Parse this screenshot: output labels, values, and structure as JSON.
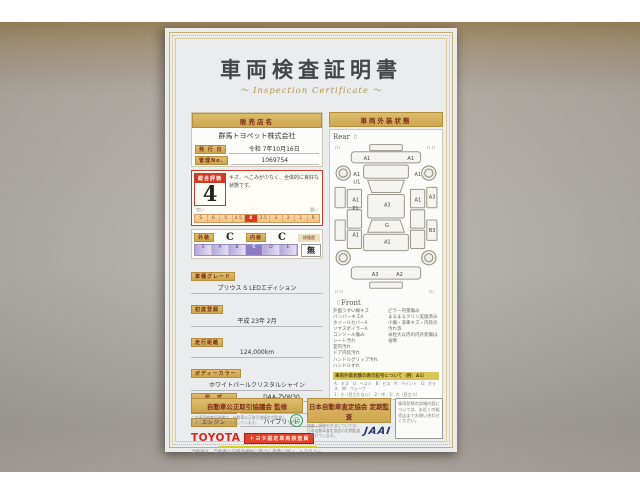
{
  "document": {
    "title": "車両検査証明書",
    "subtitle": "～ Inspection Certificate ～"
  },
  "colors": {
    "gold_bar": "#cda64f",
    "rating_red": "#cf3a26",
    "highlight_yellow": "#f2ee2a",
    "toyota_red": "#d8261c",
    "jaai_navy": "#23366e",
    "seal_green": "#2e9e4f",
    "paper": "#ebeced"
  },
  "left": {
    "dealer_header": "販売店名",
    "dealer_name": "群馬トヨペット株式会社",
    "issue_label": "発 行 日",
    "issue_value": "令和 7年10月16日",
    "manage_label": "管理No.",
    "manage_value": "1069754",
    "rating": {
      "label": "総合評価",
      "value": "4",
      "comment": "キズ、へこみが少なく、全体的に良好な状態です。",
      "scale": [
        "S",
        "6",
        "5",
        "4.5",
        "4",
        "3.5",
        "3",
        "2",
        "1",
        "R"
      ],
      "selected": "4",
      "good_label": "良い",
      "bad_label": "悪い"
    },
    "grade_row": {
      "ext_label": "外装",
      "ext_value": "C",
      "int_label": "内装",
      "int_value": "C",
      "repair_label": "修復歴",
      "repair_value": "無",
      "letters": [
        "S",
        "A",
        "B",
        "C",
        "D",
        "E"
      ],
      "selected_letter": "C"
    },
    "fields": [
      {
        "label": "車種グレード",
        "value": "プリウス S LEDエディション",
        "stacked": true
      },
      {
        "label": "初度登録",
        "value": "平成 23年 2月",
        "stacked": true
      },
      {
        "label": "走行距離",
        "value": "124,000km",
        "stacked": true
      },
      {
        "label": "ボディーカラー",
        "value": "ホワイトパールクリスタルシャイン",
        "stacked": true
      },
      {
        "label": "型　式",
        "value": "DAA-ZVW30",
        "stacked": false
      },
      {
        "label": "車台番号",
        "value": "XXXXXXX021",
        "stacked": false
      },
      {
        "label": "エンジン",
        "value": "ハイブリッド",
        "stacked": false
      }
    ],
    "toyota_logo": "TOYOTA",
    "inspector_badge": "トヨタ認定車両検査員",
    "disclaimer": "当検査は、自動車公正競争規約に基づく基準に従い、トヨタユーゼックが認定した検査員が厳正に検査・評価いたしました。"
  },
  "right": {
    "header": "車両外装状態",
    "rear_label": "Rear",
    "front_label": "Front",
    "diagram_labels": [
      {
        "t": "A1",
        "x": 30,
        "y": 17
      },
      {
        "t": "A1",
        "x": 73,
        "y": 17
      },
      {
        "t": "A1",
        "x": 20,
        "y": 33
      },
      {
        "t": "U1",
        "x": 20,
        "y": 40
      },
      {
        "t": "A1",
        "x": 19,
        "y": 58
      },
      {
        "t": "P1",
        "x": 19,
        "y": 66
      },
      {
        "t": "A1",
        "x": 19,
        "y": 92
      },
      {
        "t": "A3",
        "x": 50,
        "y": 63
      },
      {
        "t": "G",
        "x": 51,
        "y": 83
      },
      {
        "t": "A1",
        "x": 50,
        "y": 99
      },
      {
        "t": "A1",
        "x": 80,
        "y": 33
      },
      {
        "t": "A1",
        "x": 80,
        "y": 58
      },
      {
        "t": "A3",
        "x": 94,
        "y": 55
      },
      {
        "t": "B3",
        "x": 94,
        "y": 88
      },
      {
        "t": "A3",
        "x": 38,
        "y": 131
      },
      {
        "t": "A2",
        "x": 62,
        "y": 131
      }
    ],
    "wheel_marks": [
      {
        "t": "(1)",
        "x": 2,
        "y": 6
      },
      {
        "t": "(1.1)",
        "x": 92,
        "y": 6
      },
      {
        "t": "(2.1)",
        "x": 2,
        "y": 147
      },
      {
        "t": "(1)",
        "x": 94,
        "y": 147
      }
    ],
    "notes_left": [
      "外面うすい線キズ",
      "バンパーキズA",
      "ホイールカバーA",
      "リヤスポイラーA",
      "コンソール傷み",
      "シート汚れ",
      "室内汚れ",
      "ドア内装汚れ",
      "ハンドルグリップ汚れ",
      "ハンドルすれ"
    ],
    "notes_right": [
      "ピラー内張傷み",
      "まるまるクリン実施済み",
      "小傷・洗車キズ・内装の汚れ等",
      "米粒大以内の内外装傷は省略"
    ],
    "legend_header": "車両外装状態の表示記号について（例：A1）",
    "legend_lines": [
      "A：キズ　U：ヘコミ　B：ビス　P：ペイント　G：ガラス　W：ウェーブ",
      "1：小（目立たない）　2：中　3：大（目立つ）"
    ]
  },
  "footer": {
    "left_banner": "自動車公正取引協議会 監修",
    "left_note": "この車両検査証明書は、自動車公正取引協議会が監修した表示基準に基づいて作成しています。",
    "right_banner": "日本自動車査定協会 定期監査",
    "right_note": "検査・評価の方法については、日本自動車査定協会の定期監査を受けています。",
    "jaai_logo": "JAAI",
    "side_note": "車両状態の詳細内容については、お近くの販売店までお問い合わせください。"
  }
}
